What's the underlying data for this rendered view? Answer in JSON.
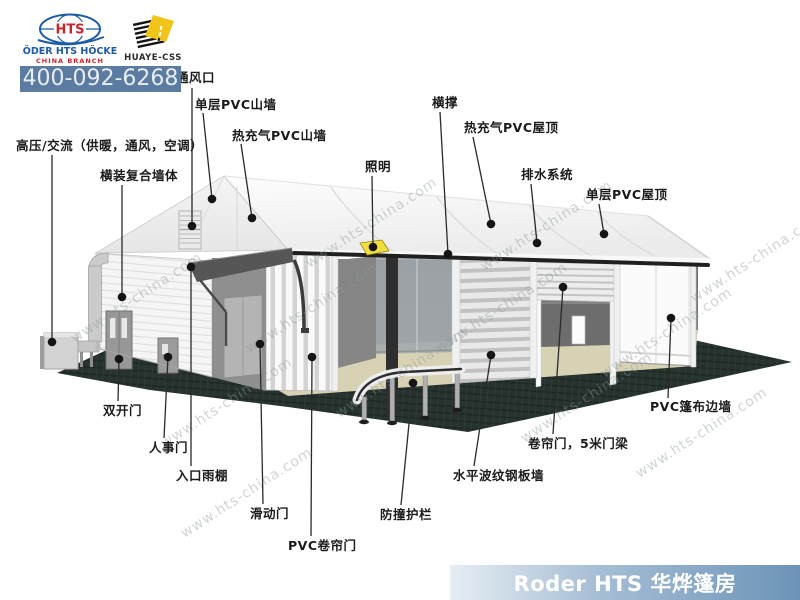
{
  "header": {
    "roder_logo": {
      "hts": "HTS",
      "line1": "RÖDER HTS HÖCKER",
      "line2": "CHINA  BRANCH"
    },
    "huaye_logo": {
      "label": "HUAYE-CSS"
    },
    "phone": "400-092-6268"
  },
  "footer": {
    "banner_text": "Roder HTS 华烨篷房"
  },
  "watermark": {
    "text": "www.hts-china.com",
    "positions": [
      [
        60,
        290
      ],
      [
        150,
        395
      ],
      [
        235,
        300
      ],
      [
        325,
        365
      ],
      [
        425,
        300
      ],
      [
        510,
        390
      ],
      [
        590,
        325
      ],
      [
        295,
        215
      ],
      [
        470,
        218
      ],
      [
        625,
        425
      ],
      [
        170,
        485
      ],
      [
        680,
        250
      ]
    ]
  },
  "colors": {
    "logo_blue": "#1d5ba6",
    "logo_red": "#cc2229",
    "huaye_yellow": "#f0c419",
    "phone_bar_bg": "#5b7ba0",
    "phone_text": "#e7edf4",
    "banner_text": "#ffffff",
    "callout_line": "#2a2a2a",
    "callout_dot": "#151515",
    "base_green": "#27332e",
    "light_fixture": "#f1dd3b"
  },
  "diagram": {
    "callouts": [
      {
        "id": "vent",
        "label": "通风口",
        "lx": 176,
        "ly": 70,
        "sx": 192,
        "sy": 88,
        "dx": 192,
        "dy": 226
      },
      {
        "id": "single-pvc-gable",
        "label": "单层PVC山墙",
        "lx": 195,
        "ly": 97,
        "sx": 203,
        "sy": 113,
        "dx": 212,
        "dy": 199
      },
      {
        "id": "inflated-pvc-gable",
        "label": "热充气PVC山墙",
        "lx": 232,
        "ly": 128,
        "sx": 241,
        "sy": 144,
        "dx": 252,
        "dy": 218
      },
      {
        "id": "hvac",
        "label": "高压/交流（供暖，通风，空调）",
        "lx": 16,
        "ly": 138,
        "sx": 52,
        "sy": 155,
        "dx": 52,
        "dy": 342
      },
      {
        "id": "composite-wall",
        "label": "横装复合墙体",
        "lx": 100,
        "ly": 168,
        "sx": 122,
        "sy": 185,
        "dx": 122,
        "dy": 297
      },
      {
        "id": "lighting",
        "label": "照明",
        "lx": 365,
        "ly": 159,
        "sx": 372,
        "sy": 176,
        "dx": 373,
        "dy": 247
      },
      {
        "id": "cross-brace",
        "label": "横撑",
        "lx": 432,
        "ly": 95,
        "sx": 440,
        "sy": 112,
        "dx": 448,
        "dy": 254
      },
      {
        "id": "inflated-pvc-roof",
        "label": "热充气PVC屋顶",
        "lx": 464,
        "ly": 120,
        "sx": 473,
        "sy": 137,
        "dx": 491,
        "dy": 224
      },
      {
        "id": "drainage",
        "label": "排水系统",
        "lx": 521,
        "ly": 167,
        "sx": 531,
        "sy": 184,
        "dx": 537,
        "dy": 243
      },
      {
        "id": "single-pvc-roof",
        "label": "单层PVC屋顶",
        "lx": 586,
        "ly": 187,
        "sx": 599,
        "sy": 204,
        "dx": 604,
        "dy": 234
      },
      {
        "id": "pvc-sidewall",
        "label": "PVC篷布边墙",
        "lx": 650,
        "ly": 399,
        "sx": 668,
        "sy": 398,
        "dx": 671,
        "dy": 318
      },
      {
        "id": "roller-door-5m",
        "label": "卷帘门，5米门梁",
        "lx": 528,
        "ly": 436,
        "sx": 553,
        "sy": 434,
        "dx": 563,
        "dy": 287
      },
      {
        "id": "corrugated-wall",
        "label": "水平波纹钢板墙",
        "lx": 453,
        "ly": 468,
        "sx": 474,
        "sy": 466,
        "dx": 491,
        "dy": 355
      },
      {
        "id": "crash-barrier",
        "label": "防撞护栏",
        "lx": 380,
        "ly": 507,
        "sx": 401,
        "sy": 505,
        "dx": 413,
        "dy": 383
      },
      {
        "id": "pvc-roller-curtain",
        "label": "PVC卷帘门",
        "lx": 288,
        "ly": 538,
        "sx": 311,
        "sy": 536,
        "dx": 312,
        "dy": 357
      },
      {
        "id": "sliding-door",
        "label": "滑动门",
        "lx": 250,
        "ly": 506,
        "sx": 263,
        "sy": 504,
        "dx": 260,
        "dy": 344
      },
      {
        "id": "entrance-canopy",
        "label": "入口雨棚",
        "lx": 176,
        "ly": 468,
        "sx": 191,
        "sy": 466,
        "dx": 191,
        "dy": 267
      },
      {
        "id": "personnel-door",
        "label": "人事门",
        "lx": 149,
        "ly": 440,
        "sx": 164,
        "sy": 438,
        "dx": 168,
        "dy": 357
      },
      {
        "id": "double-door",
        "label": "双开门",
        "lx": 103,
        "ly": 403,
        "sx": 118,
        "sy": 401,
        "dx": 119,
        "dy": 359
      }
    ]
  }
}
